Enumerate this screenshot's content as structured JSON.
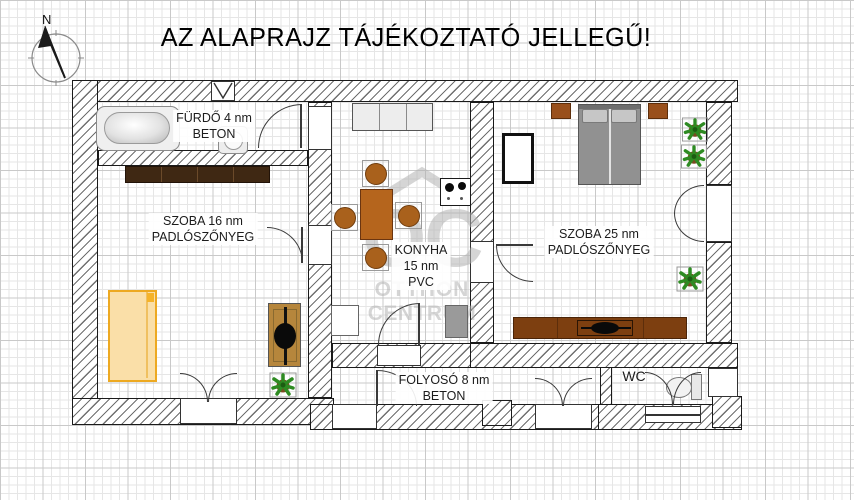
{
  "title": "AZ ALAPRAJZ TÁJÉKOZTATÓ JELLEGŰ!",
  "compass": {
    "north_label": "N"
  },
  "watermark": {
    "monogram": "OC",
    "line1": "OTTHON",
    "line2": "CENTRUM"
  },
  "rooms": {
    "bathroom": {
      "line1": "FÜRDŐ 4 nm",
      "line2": "BETON"
    },
    "room16": {
      "line1": "SZOBA 16 nm",
      "line2": "PADLÓSZŐNYEG"
    },
    "kitchen": {
      "line1": "KONYHA",
      "line2": "15 nm",
      "line3": "PVC"
    },
    "room25": {
      "line1": "SZOBA 25 nm",
      "line2": "PADLÓSZŐNYEG"
    },
    "hallway": {
      "line1": "FOLYOSÓ 8 nm",
      "line2": "BETON"
    },
    "wc": {
      "line1": "WC"
    }
  },
  "colors": {
    "wall_outline": "#1a1a1a",
    "wall_hatch": "#6f6f6f",
    "wardrobe_dark_wood": "#3f2813",
    "bed_orange_border": "#eda921",
    "bed_orange_fill": "#fadfa8",
    "desk_tan": "#b6863c",
    "kitchen_table_brown": "#b5651d",
    "chair_brown": "#a9611c",
    "sideboard_brown": "#7d3f10",
    "nightstand_brown": "#99501c",
    "bed_gray": "#919191",
    "pillow_gray": "#c6c6c6",
    "fridge_gray": "#9a9a9a",
    "counter_gray": "#ededed",
    "plant_green": "#2e8b22",
    "pot_brown": "#7a4a21",
    "watermark_gray": "#b3b3b3"
  }
}
